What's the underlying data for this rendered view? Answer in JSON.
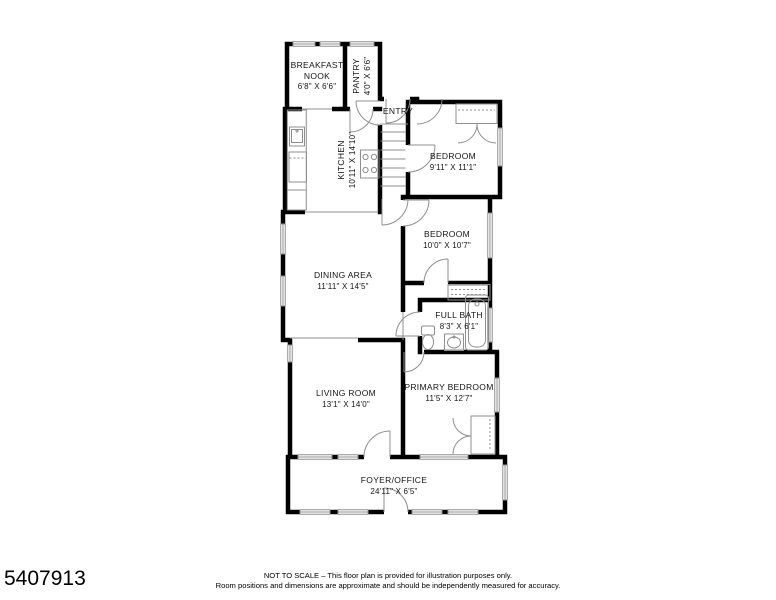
{
  "plan": {
    "rooms": {
      "breakfast_nook": {
        "name": "BREAKFAST NOOK",
        "dims": "6'8\" X 6'6\""
      },
      "pantry": {
        "name": "PANTRY",
        "dims": "4'0\" X 6'6\""
      },
      "kitchen": {
        "name": "KITCHEN",
        "dims": "10'11\" X 14'10\""
      },
      "entry": {
        "name": "ENTRY"
      },
      "bedroom1": {
        "name": "BEDROOM",
        "dims": "9'11\" X 11'1\""
      },
      "bedroom2": {
        "name": "BEDROOM",
        "dims": "10'0\" X 10'7\""
      },
      "dining_area": {
        "name": "DINING AREA",
        "dims": "11'11\" X 14'5\""
      },
      "full_bath": {
        "name": "FULL BATH",
        "dims": "8'3\" X 6'1\""
      },
      "living_room": {
        "name": "LIVING ROOM",
        "dims": "13'1\" X 14'0\""
      },
      "primary_bedroom": {
        "name": "PRIMARY BEDROOM",
        "dims": "11'5\" X 12'7\""
      },
      "foyer_office": {
        "name": "FOYER/OFFICE",
        "dims": "24'11\" X 6'5\""
      }
    }
  },
  "footer": {
    "listing_id": "5407913",
    "disclaimer_line1": "NOT TO SCALE – This floor plan is provided for illustration purposes only.",
    "disclaimer_line2": "Room positions and dimensions are approximate and should be independently measured for accuracy."
  },
  "colors": {
    "wall": "#000000",
    "thin": "#8f8f8f",
    "background": "#ffffff",
    "text": "#000000"
  }
}
